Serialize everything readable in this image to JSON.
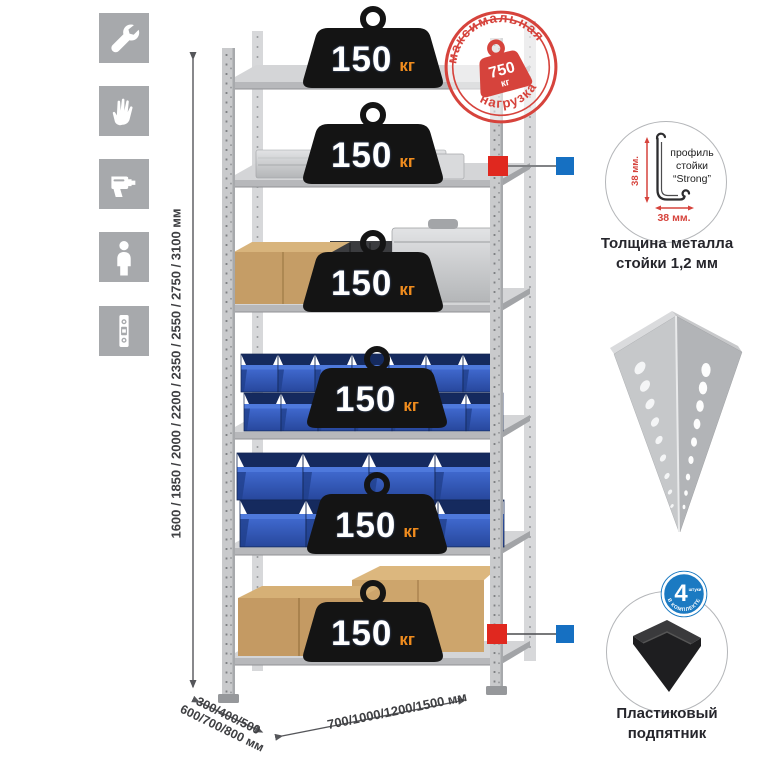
{
  "colors": {
    "tile_gray": "#a7a9ac",
    "stamp_red": "#d6433c",
    "badge_black": "#141414",
    "kg_orange": "#f08c1e",
    "bin_blue": "#3058b8",
    "connector_red": "#e0281f",
    "connector_blue": "#1670c2",
    "metal_gray": "#c6c8ca"
  },
  "sidebar": {
    "tiles": [
      {
        "name": "wrench-icon"
      },
      {
        "name": "gloves-icon"
      },
      {
        "name": "drill-icon"
      },
      {
        "name": "person-icon"
      },
      {
        "name": "level-icon"
      }
    ]
  },
  "dimensions": {
    "height": "1600 / 1850 / 2000 / 2200 / 2350 / 2550 / 2750 / 3100 мм",
    "depth_line1": "300/400/500",
    "depth_line2": "600/700/800 мм",
    "width": "700/1000/1200/1500 мм"
  },
  "shelf_load": {
    "value": "150",
    "unit": "кг",
    "shelf_count": 6
  },
  "max_load": {
    "word_top": "максимальная",
    "word_bottom": "нагрузка",
    "value": "750",
    "unit": "кг"
  },
  "profile": {
    "line1": "профиль",
    "line2": "стойки",
    "line3": "“Strong”",
    "dim_v": "38 мм.",
    "dim_h": "38 мм.",
    "caption1": "Толщина металла",
    "caption2": "стойки 1,2 мм"
  },
  "foot": {
    "badge_number": "4",
    "badge_word_small": "штуки",
    "badge_word_curved": "В КОМПЛЕКТЕ",
    "caption1": "Пластиковый",
    "caption2": "подпятник"
  }
}
